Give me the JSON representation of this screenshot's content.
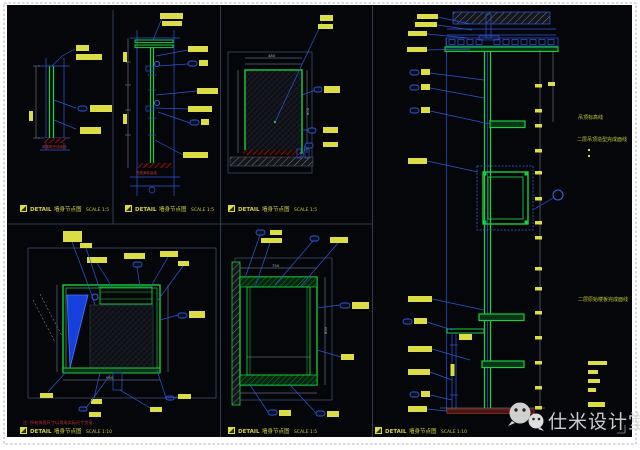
{
  "page": {
    "background": "#ffffff",
    "canvas_color": "#05060a",
    "line_green": "#17cf3f",
    "line_blue": "#2e57d8",
    "label_yellow": "#dcdc46",
    "hatch_red": "#b43028"
  },
  "watermark": {
    "text": "仕米设计堂",
    "icon": "wechat-icon"
  },
  "titles": [
    {
      "detail_label": "DETAIL",
      "drawing_name": "墙身节点图",
      "scale_label": "SCALE 1:5"
    },
    {
      "detail_label": "DETAIL",
      "drawing_name": "墙身节点图",
      "scale_label": "SCALE 1:5"
    },
    {
      "detail_label": "DETAIL",
      "drawing_name": "墙身节点图",
      "scale_label": "SCALE 1:5"
    },
    {
      "detail_label": "DETAIL",
      "drawing_name": "墙身节点图",
      "scale_label": "SCALE 1:10"
    },
    {
      "detail_label": "DETAIL",
      "drawing_name": "墙身节点图",
      "scale_label": "SCALE 1:5"
    },
    {
      "detail_label": "DETAIL",
      "drawing_name": "墙身节点图",
      "scale_label": "SCALE 1:10"
    }
  ],
  "annotations": {
    "ceiling_level_note": "吊顶标高线",
    "ceiling_finish_note": "二层吊顶造型完成面线",
    "slab_line_note": "二层原始楼板完成面线",
    "site_note": "注: 所有饰面尺寸以现场实际尺寸为准.",
    "floor_note_1": "原建筑完成面线",
    "floor_note_2": "完成面标高线"
  },
  "dimensions": {
    "w480": "480",
    "h600": "600",
    "w960": "960",
    "w750": "750",
    "h850": "850"
  }
}
